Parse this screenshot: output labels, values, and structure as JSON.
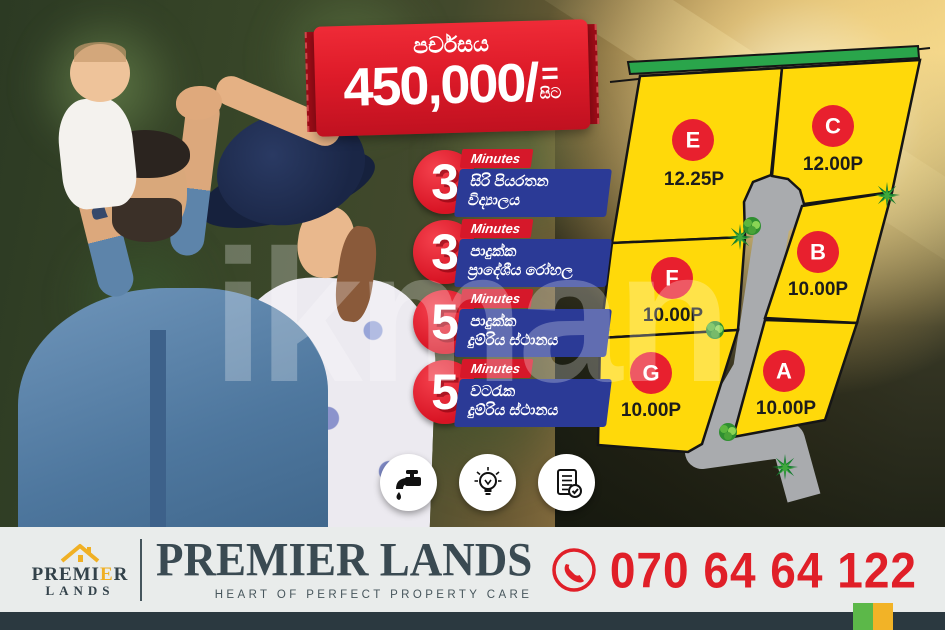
{
  "watermark_text": "ikman",
  "price_banner": {
    "label": "පර්චසය",
    "amount": "450,000/",
    "equals": "=",
    "from_label": "සිට"
  },
  "badges": [
    {
      "number": "3",
      "unit": "Minutes",
      "line1": "සිරි පියරතන",
      "line2": "විද්‍යාලය"
    },
    {
      "number": "3",
      "unit": "Minutes",
      "line1": "පාදුක්ක",
      "line2": "ප්‍රාදේශීය රෝහල"
    },
    {
      "number": "5",
      "unit": "Minutes",
      "line1": "පාදුක්ක",
      "line2": "දුම්රිය ස්ථානය"
    },
    {
      "number": "5",
      "unit": "Minutes",
      "line1": "වටරැක",
      "line2": "දුම්රිය ස්ථානය"
    }
  ],
  "plot_map": {
    "plots": [
      {
        "id": "E",
        "size": "12.25P"
      },
      {
        "id": "C",
        "size": "12.00P"
      },
      {
        "id": "F",
        "size": "10.00P"
      },
      {
        "id": "B",
        "size": "10.00P"
      },
      {
        "id": "G",
        "size": "10.00P"
      },
      {
        "id": "A",
        "size": "10.00P"
      }
    ],
    "colors": {
      "plot_fill": "#FFD90A",
      "plot_border": "#151515",
      "road": "#a9abae",
      "frontage_strip": "#2aa54b",
      "label_circle": "#e8202e"
    }
  },
  "amenities": [
    {
      "icon": "water-tap-icon"
    },
    {
      "icon": "light-bulb-icon"
    },
    {
      "icon": "approved-deed-icon"
    }
  ],
  "footer": {
    "logo": {
      "top_left": "PREMI",
      "top_accent": "E",
      "top_right": "R",
      "bottom": "LANDS"
    },
    "brand": "PREMIER LANDS",
    "tagline": "HEART OF PERFECT PROPERTY CARE",
    "phone": "070 64 64 122"
  },
  "colors": {
    "ribbon_red": "#de1b29",
    "badge_blue": "#2b3a96",
    "footer_band": "#e9eceb",
    "footer_dark_strip": "#2b3940",
    "phone_red": "#e01f28",
    "logo_yellow": "#f0b024",
    "corner_green": "#5cb849",
    "corner_yellow": "#f2b327"
  }
}
